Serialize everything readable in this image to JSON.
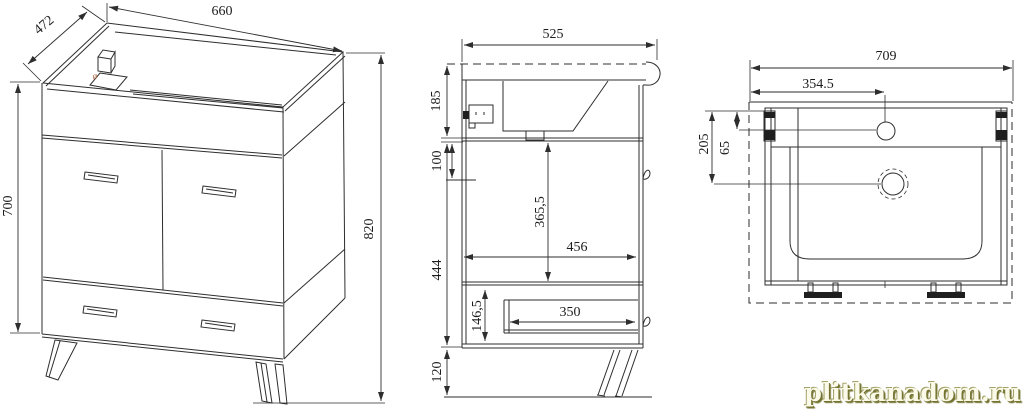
{
  "drawing_title": "bathroom vanity cabinet - three view technical drawing",
  "front_view": {
    "top_width": "660",
    "depth": "472",
    "body_height": "700",
    "overall_height": "820",
    "hole_mark": "ø"
  },
  "side_view": {
    "depth": "525",
    "sink_zone_height": "185",
    "top_offset": "100",
    "inner_height": "365,5",
    "body_height": "444",
    "inner_depth": "456",
    "drawer_inner_height": "146,5",
    "drawer_depth": "350",
    "leg_height": "120"
  },
  "top_view": {
    "overall_width": "709",
    "faucet_offset_x": "354.5",
    "holes_depth": "205",
    "faucet_offset_y": "65"
  },
  "watermark": {
    "text": "plitkanadom.ru"
  },
  "colors": {
    "line": "#2e2e2e",
    "accent_mark": "#b5653c",
    "watermark_face": "#fbfae8",
    "watermark_shadow": "#73722f"
  }
}
